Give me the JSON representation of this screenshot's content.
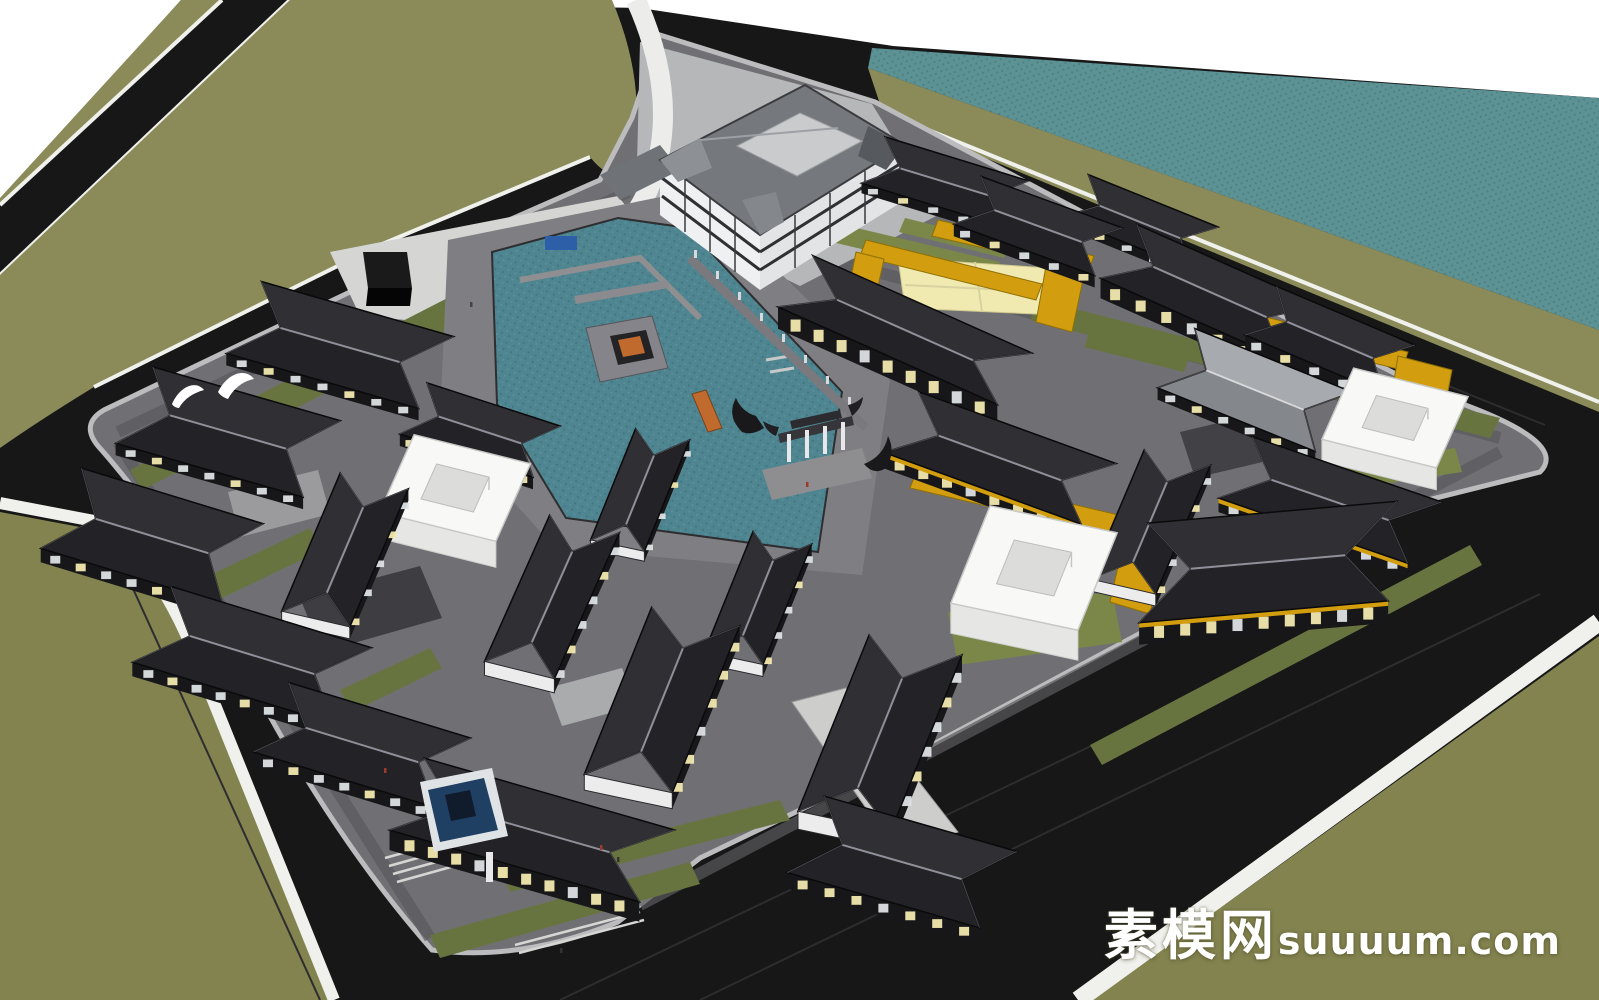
{
  "watermark": {
    "site_name_cn": "素模网",
    "domain_suffix": "suuuum.com"
  },
  "palette": {
    "sky": "#ffffff",
    "field": "#8b8b59",
    "fieldDark": "#83834f",
    "water": "#5d9295",
    "waterDot": "#4c8184",
    "asphalt": "#171718",
    "asphaltLine": "#2d2d2f",
    "curb": "#f0f0ec",
    "pavement": "#707074",
    "pavementMid": "#8b8b8f",
    "pavementLight": "#bcbcbe",
    "plazaLight": "#d5d5d3",
    "lawn": "#68743f",
    "lawnLight": "#7a8749",
    "roofDark": "#232327",
    "roofDark2": "#2f2f34",
    "ridge": "#90909a",
    "roofGray": "#75787d",
    "roofGrayLight": "#a7aaaf",
    "hotelCourt": "#c9cbcd",
    "facadeWhite": "#eef0f1",
    "wallDark": "#17171a",
    "windowWarm": "#f2e8ae",
    "windowCool": "#dde1e4",
    "whiteBox": "#f8f8f6",
    "whiteBoxSide": "#e6e6e4",
    "amber": "#d29d0e",
    "amberDark": "#8f7006",
    "courtYellow": "#f0eab0",
    "poolBlue": "#1f3f63",
    "wood": "#c06a2e",
    "fence": "#7a7a7e",
    "stairs": "#d6d6d4"
  }
}
